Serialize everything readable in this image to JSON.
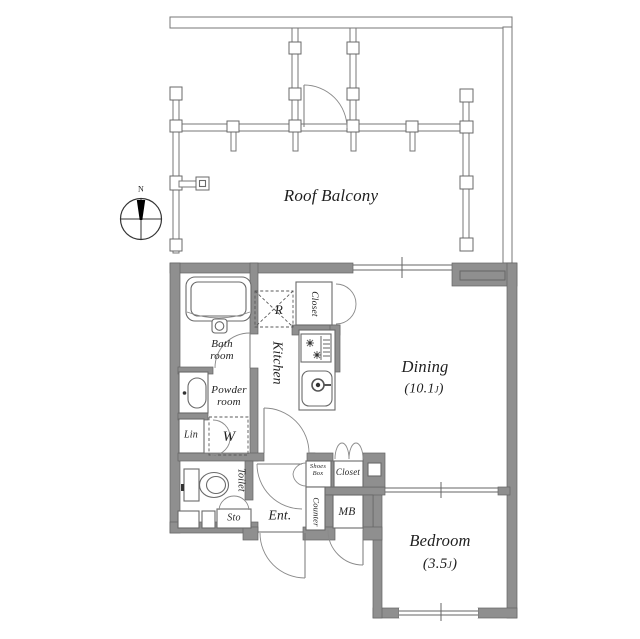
{
  "colors": {
    "wall": "#8f8f8f",
    "wall_edge": "#636363",
    "line": "#666666",
    "text": "#1f1f1f"
  },
  "compass": {
    "label": "N"
  },
  "balcony": {
    "label": "Roof Balcony"
  },
  "rooms": {
    "bathroom": {
      "line1": "Bath",
      "line2": "room"
    },
    "powder_room": {
      "line1": "Powder",
      "line2": "room"
    },
    "linen": {
      "label": "Lin"
    },
    "washer": {
      "label": "W"
    },
    "toilet": {
      "label": "Toilet"
    },
    "storage": {
      "label": "Sto"
    },
    "kitchen": {
      "label": "Kitchen"
    },
    "refrigerator": {
      "label": "R"
    },
    "kitchen_closet": {
      "label": "Closet"
    },
    "dining": {
      "label": "Dining",
      "area_open": "(10.1",
      "area_unit": "J",
      "area_close": ")"
    },
    "entrance": {
      "label": "Ent."
    },
    "shoes_box": {
      "line1": "Shoes",
      "line2": "Box"
    },
    "entrance_closet": {
      "label": "Closet"
    },
    "counter": {
      "label": "Counter"
    },
    "meter_box": {
      "label": "MB"
    },
    "bedroom": {
      "label": "Bedroom",
      "area_open": "(3.5",
      "area_unit": "J",
      "area_close": ")"
    }
  }
}
